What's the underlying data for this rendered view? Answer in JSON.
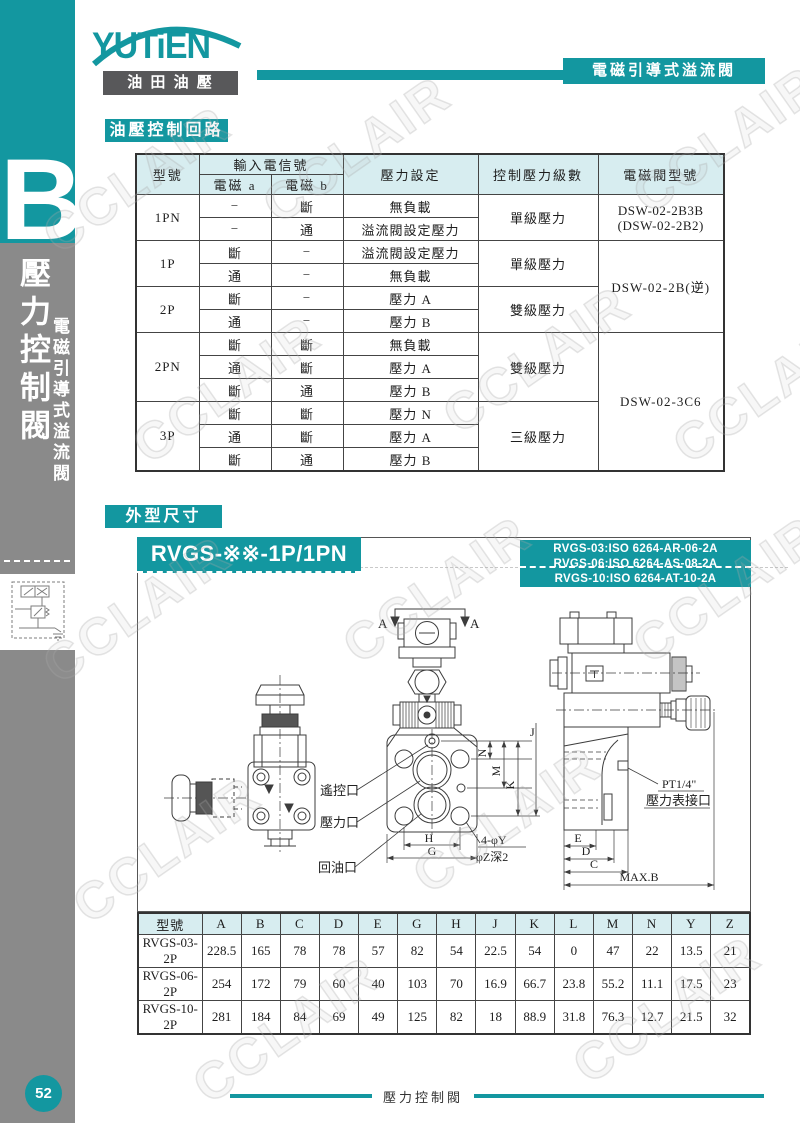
{
  "colors": {
    "teal": "#1397a0",
    "table_header_bg": "#d7edf0",
    "sidebar_gray": "#8a8a8a",
    "logo_box_gray": "#58585a"
  },
  "header": {
    "logo_text": "YUTiEN",
    "logo_subtext": "油 田 油 壓",
    "page_topic": "電磁引導式溢流閥"
  },
  "sidebar": {
    "tab_letter": "B",
    "title": "壓力控制閥",
    "subtitle": "電磁引導式溢流閥",
    "page_number": "52"
  },
  "sections": {
    "circuit": "油壓控制回路",
    "dimensions": "外型尺寸"
  },
  "watermark": "CCLAIR",
  "circuit_table": {
    "col_model": "型號",
    "col_input": "輸入電信號",
    "col_sol_a": "電磁 a",
    "col_sol_b": "電磁 b",
    "col_pressure": "壓力設定",
    "col_level": "控制壓力級數",
    "col_valve": "電磁閥型號",
    "models": [
      "1PN",
      "1P",
      "2P",
      "2PN",
      "3P"
    ],
    "levels": [
      "單級壓力",
      "單級壓力",
      "雙級壓力",
      "雙級壓力",
      "三級壓力"
    ],
    "valves": {
      "v1_line1": "DSW-02-2B3B",
      "v1_line2": "(DSW-02-2B2)",
      "v2": "DSW-02-2B(逆)",
      "v3": "DSW-02-3C6"
    },
    "rows": [
      [
        "−",
        "斷",
        "無負載"
      ],
      [
        "−",
        "通",
        "溢流閥設定壓力"
      ],
      [
        "斷",
        "−",
        "溢流閥設定壓力"
      ],
      [
        "通",
        "−",
        "無負載"
      ],
      [
        "斷",
        "−",
        "壓力 A"
      ],
      [
        "通",
        "−",
        "壓力 B"
      ],
      [
        "斷",
        "斷",
        "無負載"
      ],
      [
        "通",
        "斷",
        "壓力 A"
      ],
      [
        "斷",
        "通",
        "壓力 B"
      ],
      [
        "斷",
        "斷",
        "壓力 N"
      ],
      [
        "通",
        "斷",
        "壓力 A"
      ],
      [
        "斷",
        "通",
        "壓力 B"
      ]
    ]
  },
  "drawing": {
    "title": "RVGS-※※-1P/1PN",
    "iso_lines": [
      "RVGS-03:ISO 6264-AR-06-2A",
      "RVGS-06:ISO 6264-AS-08-2A",
      "RVGS-10:ISO 6264-AT-10-2A"
    ],
    "labels": {
      "section": "A",
      "remote_port": "遙控口",
      "pressure_port": "壓力口",
      "return_port": "回油口",
      "dim_h": "H",
      "dim_g": "G",
      "dim_n": "N",
      "dim_m": "M",
      "dim_k": "K",
      "dim_j": "J",
      "holes": "4-φY",
      "hole_depth": "φZ深2",
      "dim_e": "E",
      "dim_d": "D",
      "dim_c": "C",
      "dim_max_b": "MAX.B",
      "gauge_size": "PT1/4\"",
      "gauge_port": "壓力表接口"
    }
  },
  "dims_table": {
    "headers": [
      "型號",
      "A",
      "B",
      "C",
      "D",
      "E",
      "G",
      "H",
      "J",
      "K",
      "L",
      "M",
      "N",
      "Y",
      "Z"
    ],
    "rows": [
      [
        "RVGS-03-2P",
        "228.5",
        "165",
        "78",
        "78",
        "57",
        "82",
        "54",
        "22.5",
        "54",
        "0",
        "47",
        "22",
        "13.5",
        "21"
      ],
      [
        "RVGS-06-2P",
        "254",
        "172",
        "79",
        "60",
        "40",
        "103",
        "70",
        "16.9",
        "66.7",
        "23.8",
        "55.2",
        "11.1",
        "17.5",
        "23"
      ],
      [
        "RVGS-10-2P",
        "281",
        "184",
        "84",
        "69",
        "49",
        "125",
        "82",
        "18",
        "88.9",
        "31.8",
        "76.3",
        "12.7",
        "21.5",
        "32"
      ]
    ]
  },
  "footer": {
    "title": "壓力控制閥"
  }
}
